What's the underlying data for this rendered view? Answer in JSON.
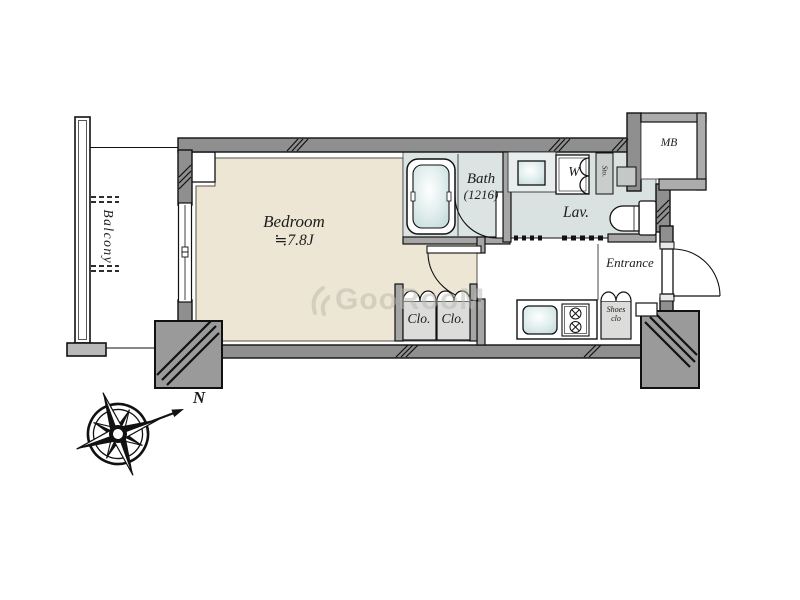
{
  "floorplan": {
    "rooms": {
      "balcony": {
        "label": "Balcony"
      },
      "bedroom": {
        "label": "Bedroom",
        "size": "≒7.8J"
      },
      "bath": {
        "label": "Bath",
        "size": "(1216)"
      },
      "lavatory": {
        "label": "Lav."
      },
      "washer": {
        "label": "W"
      },
      "storage": {
        "label": "Sto."
      },
      "meter_box": {
        "label": "MB"
      },
      "entrance": {
        "label": "Entrance"
      },
      "shoes_closet": {
        "line1": "Shoes",
        "line2": "clo"
      },
      "closet1": {
        "label": "Clo."
      },
      "closet2": {
        "label": "Clo."
      }
    },
    "compass": {
      "north_label": "N"
    },
    "watermark": {
      "text": "GooRooM"
    },
    "colors": {
      "bedroom_floor": "#EDE6D4",
      "wet_area_floor": "#DBE3E3",
      "wall_gray": "#8F8F8F",
      "pillar_gray": "#9A9A9A",
      "closet_gray": "#DCDCDB",
      "line_black": "#111111"
    }
  }
}
